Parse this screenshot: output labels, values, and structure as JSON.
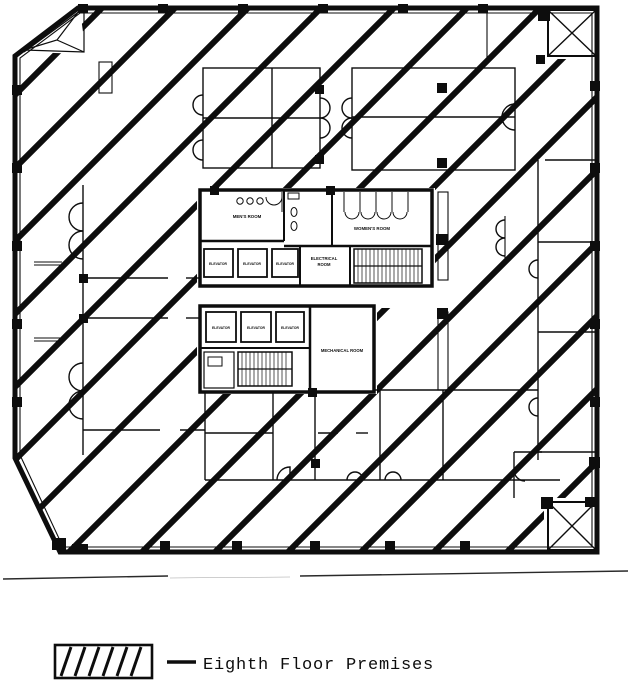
{
  "plan": {
    "labels": {
      "mens_room": "MEN'S ROOM",
      "womens_room": "WOMEN'S ROOM",
      "electrical_line1": "ELECTRICAL",
      "electrical_line2": "ROOM",
      "elevator": "ELEVATOR",
      "mechanical_room": "MECHANICAL ROOM"
    },
    "colors": {
      "ink": "#0d0d0d",
      "paper": "#ffffff"
    }
  },
  "legend": {
    "swatch_icon": "diagonal-hatch-swatch",
    "label": "Eighth Floor Premises"
  }
}
